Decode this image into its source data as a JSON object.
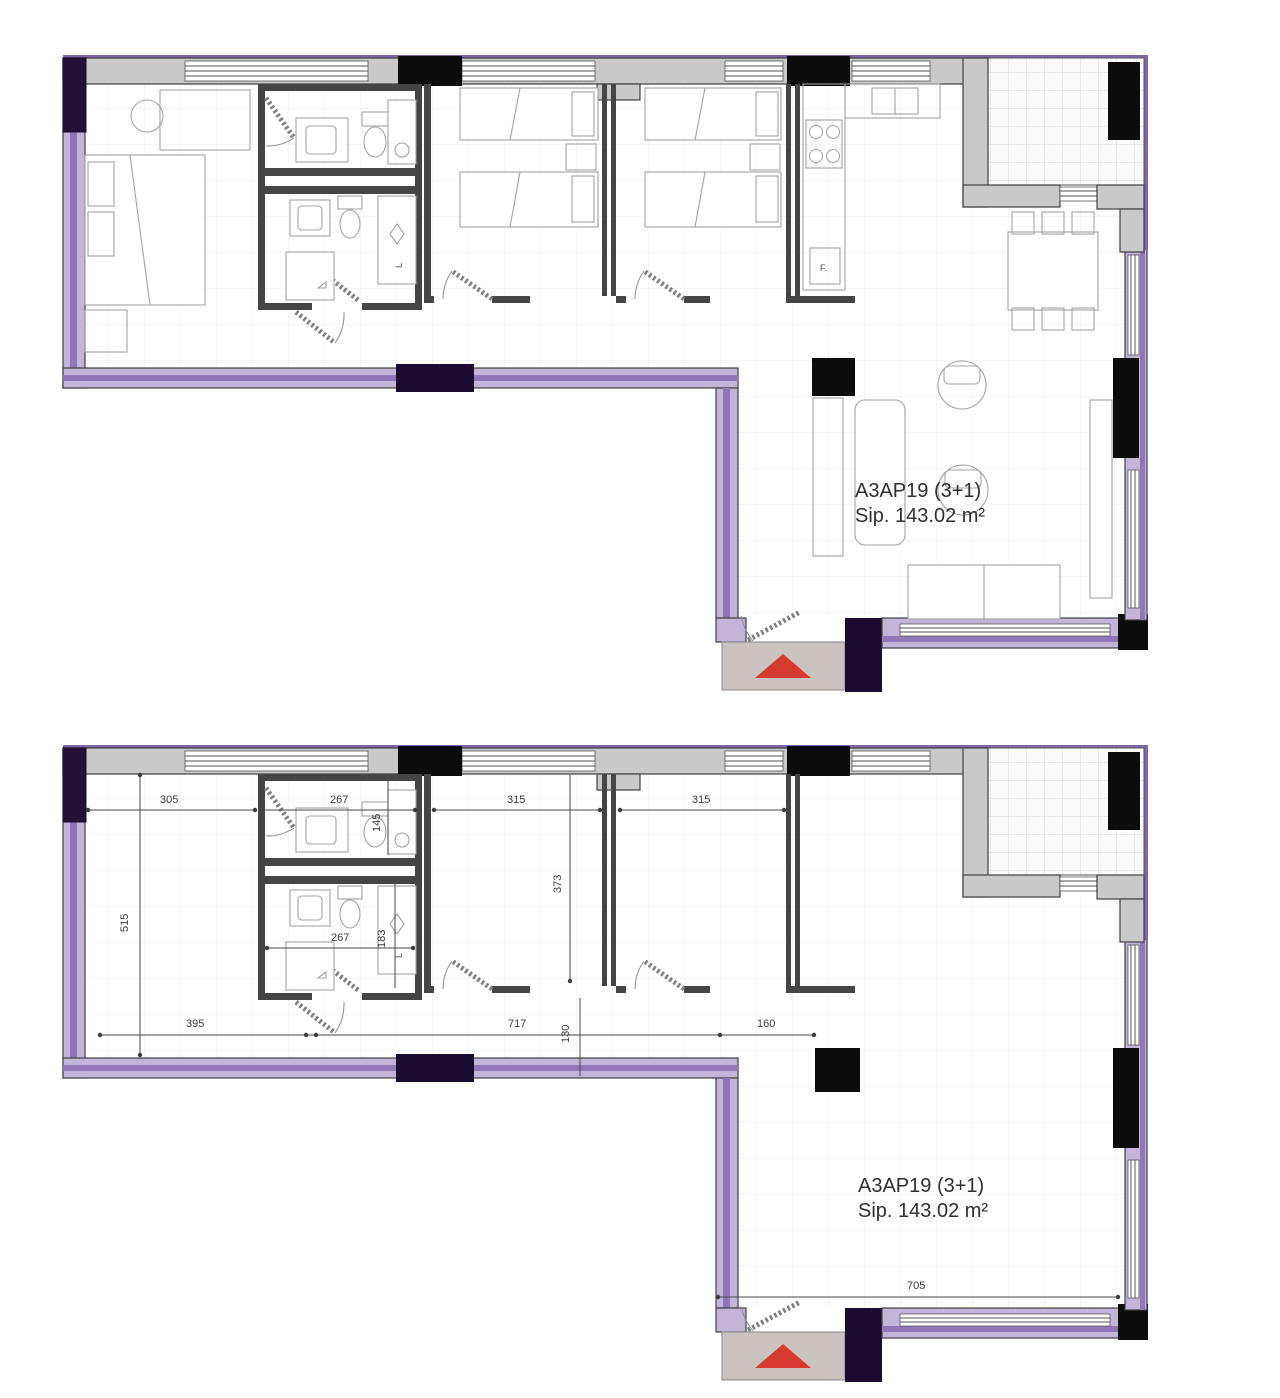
{
  "sheet": {
    "background": "#ffffff",
    "type": "apartment floor plans, furnished above and dimensioned below"
  },
  "colors": {
    "wall_gray": "#c9c9c9",
    "wall_dark": "#3f3f3f",
    "masonry_purple": "#c3b4da",
    "masonry_stripe": "#8f77b8",
    "corner_dark_purple": "#241138",
    "shaft_black": "#0c0c0c",
    "entry_floor": "#cbc3bf",
    "entry_arrow_red": "#d63a2f",
    "dim_text": "#3c3c3c",
    "label_text": "#2f2f2f"
  },
  "upper_plan": {
    "title": "A3AP19 (3+1)",
    "area": "Sip. 143.02 m²",
    "washer_label": "L",
    "kitchen_label": "F."
  },
  "lower_plan": {
    "title": "A3AP19 (3+1)",
    "area": "Sip. 143.02 m²",
    "washer_label": "L",
    "dimensions": {
      "bedroom1_width": "305",
      "bath1_width": "267",
      "bath1_right_depth": "145",
      "bedroom2_width": "315",
      "bedroom3_width": "315",
      "left_side_depth": "515",
      "bedroom_depth": "373",
      "bath2_width": "267",
      "bath2_right_depth": "183",
      "hall_width": "395",
      "corridor_width": "717",
      "wall_offset": "130",
      "column_offset": "160",
      "living_width": "705"
    }
  }
}
